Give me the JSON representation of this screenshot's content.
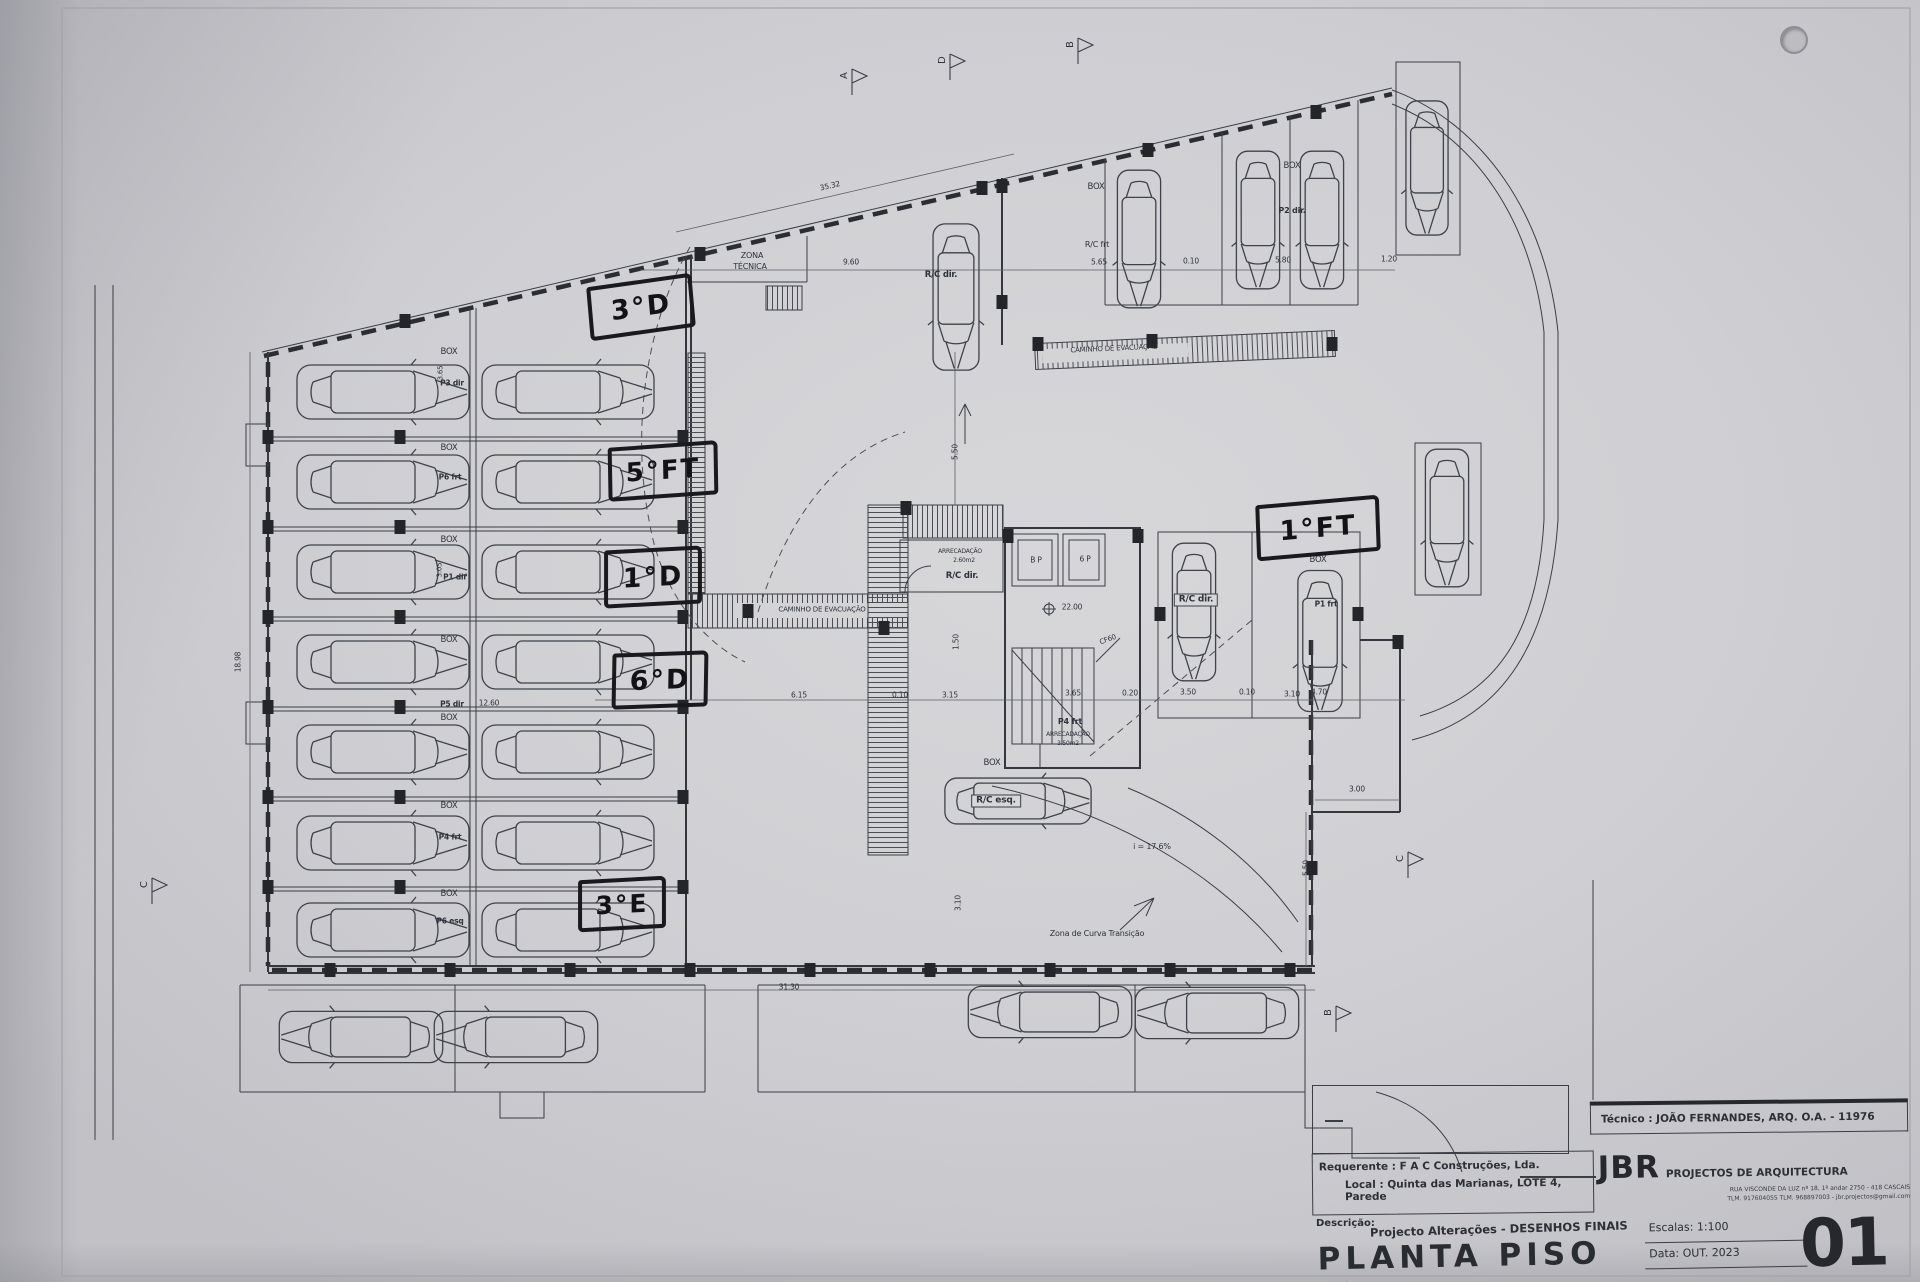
{
  "title_block": {
    "tecnico": "Técnico : JOÃO FERNANDES, ARQ.   O.A. - 11976",
    "firm_initials": "JBR",
    "firm_name": "PROJECTOS DE ARQUITECTURA",
    "firm_address": "RUA VISCONDE DA LUZ nº 18, 1º andar  2750 - 418  CASCAIS",
    "firm_contacts": "TLM. 917604055  TLM. 968897003 - jbr.projectos@gmail.com",
    "requerente": "Requerente : F A C  Construções, Lda.",
    "local": "Local : Quinta das Marianas, LOTE 4, Parede",
    "descricao_label": "Descrição:",
    "descricao": "Projecto Alterações - DESENHOS FINAIS",
    "title": "PLANTA PISO -2",
    "escala": "Escalas:  1:100",
    "data": "Data:  OUT.  2023",
    "sheet_number": "01"
  },
  "handwritten": [
    {
      "t": "3°D",
      "x": 588,
      "y": 280,
      "w": 98,
      "h": 46,
      "r": -8,
      "fs": 27
    },
    {
      "t": "5°FT",
      "x": 608,
      "y": 444,
      "w": 102,
      "h": 46,
      "r": -4,
      "fs": 26
    },
    {
      "t": "1°D",
      "x": 604,
      "y": 548,
      "w": 90,
      "h": 50,
      "r": -3,
      "fs": 27
    },
    {
      "t": "6°D",
      "x": 612,
      "y": 652,
      "w": 88,
      "h": 48,
      "r": -2,
      "fs": 27
    },
    {
      "t": "3°E",
      "x": 578,
      "y": 878,
      "w": 80,
      "h": 44,
      "r": -3,
      "fs": 25
    },
    {
      "t": "1°FT",
      "x": 1256,
      "y": 500,
      "w": 116,
      "h": 48,
      "r": -5,
      "fs": 27
    }
  ],
  "labels": [
    {
      "t": "ZONA",
      "x": 752,
      "y": 256,
      "s": 8
    },
    {
      "t": "TÉCNICA",
      "x": 750,
      "y": 267,
      "s": 8
    },
    {
      "t": "CAMINHO  DE  EVACUAÇÃO",
      "x": 822,
      "y": 610,
      "s": 7
    },
    {
      "t": "CAMINHO  DE  EVACUAÇÃO",
      "x": 1114,
      "y": 349,
      "s": 7,
      "r": -2.5
    },
    {
      "t": "BOX",
      "x": 449,
      "y": 352,
      "s": 8.5
    },
    {
      "t": "BOX",
      "x": 449,
      "y": 448,
      "s": 8.5
    },
    {
      "t": "BOX",
      "x": 449,
      "y": 540,
      "s": 8.5
    },
    {
      "t": "BOX",
      "x": 449,
      "y": 640,
      "s": 8.5
    },
    {
      "t": "BOX",
      "x": 449,
      "y": 718,
      "s": 8.5
    },
    {
      "t": "BOX",
      "x": 449,
      "y": 806,
      "s": 8.5
    },
    {
      "t": "BOX",
      "x": 449,
      "y": 894,
      "s": 8.5
    },
    {
      "t": "P3 dir",
      "x": 452,
      "y": 383,
      "s": 7.5,
      "b": 1
    },
    {
      "t": "P6 frt",
      "x": 450,
      "y": 477,
      "s": 7.5,
      "b": 1
    },
    {
      "t": "P1 dir",
      "x": 455,
      "y": 577,
      "s": 7.5,
      "b": 1
    },
    {
      "t": "P5 dir",
      "x": 452,
      "y": 704,
      "s": 7.5,
      "b": 1
    },
    {
      "t": "P4 frt",
      "x": 450,
      "y": 837,
      "s": 7.5,
      "b": 1
    },
    {
      "t": "P6 esq",
      "x": 450,
      "y": 921,
      "s": 7.5,
      "b": 1
    },
    {
      "t": "3.65",
      "x": 441,
      "y": 373,
      "s": 7,
      "r": -90
    },
    {
      "t": "3.05",
      "x": 440,
      "y": 570,
      "s": 7,
      "r": -90
    },
    {
      "t": "12.60",
      "x": 489,
      "y": 703,
      "s": 7.5
    },
    {
      "t": "18.98",
      "x": 238,
      "y": 662,
      "s": 7.5,
      "r": -90
    },
    {
      "t": "35.32",
      "x": 830,
      "y": 186,
      "s": 7.5,
      "r": -13
    },
    {
      "t": "9.60",
      "x": 851,
      "y": 262,
      "s": 7.5
    },
    {
      "t": "5.65",
      "x": 1099,
      "y": 262,
      "s": 7.5
    },
    {
      "t": "0.10",
      "x": 1191,
      "y": 261,
      "s": 7.5
    },
    {
      "t": "5.80",
      "x": 1283,
      "y": 260,
      "s": 7.5
    },
    {
      "t": "1.20",
      "x": 1389,
      "y": 259,
      "s": 7.5
    },
    {
      "t": "6.15",
      "x": 799,
      "y": 695,
      "s": 7.5
    },
    {
      "t": "0.10",
      "x": 900,
      "y": 695,
      "s": 7.5
    },
    {
      "t": "3.15",
      "x": 950,
      "y": 695,
      "s": 7.5
    },
    {
      "t": "3.65",
      "x": 1073,
      "y": 693,
      "s": 7.5
    },
    {
      "t": "0.20",
      "x": 1130,
      "y": 693,
      "s": 7.5
    },
    {
      "t": "3.50",
      "x": 1188,
      "y": 692,
      "s": 7.5
    },
    {
      "t": "0.10",
      "x": 1247,
      "y": 692,
      "s": 7.5
    },
    {
      "t": "3.10",
      "x": 1292,
      "y": 694,
      "s": 7.5
    },
    {
      "t": "4.70",
      "x": 1319,
      "y": 692,
      "s": 7.5
    },
    {
      "t": "3.00",
      "x": 1357,
      "y": 789,
      "s": 7.5
    },
    {
      "t": "5.50",
      "x": 1306,
      "y": 868,
      "s": 7.5,
      "r": -90
    },
    {
      "t": "5.50",
      "x": 955,
      "y": 452,
      "s": 7.5,
      "r": -90
    },
    {
      "t": "1.50",
      "x": 956,
      "y": 642,
      "s": 7.5,
      "r": -90
    },
    {
      "t": "3.10",
      "x": 958,
      "y": 903,
      "s": 7.5,
      "r": -90
    },
    {
      "t": "31.30",
      "x": 789,
      "y": 987,
      "s": 7.5
    },
    {
      "t": "BOX",
      "x": 1096,
      "y": 187,
      "s": 8.5
    },
    {
      "t": "R/C frt",
      "x": 1097,
      "y": 245,
      "s": 8
    },
    {
      "t": "BOX",
      "x": 1292,
      "y": 166,
      "s": 8.5
    },
    {
      "t": "P2 dir.",
      "x": 1292,
      "y": 211,
      "s": 8,
      "b": 1
    },
    {
      "t": "R/C dir.",
      "x": 941,
      "y": 275,
      "s": 8.5,
      "b": 1
    },
    {
      "t": "BOX",
      "x": 1318,
      "y": 560,
      "s": 8.5
    },
    {
      "t": "P1 frt",
      "x": 1326,
      "y": 604,
      "s": 7.5,
      "b": 1
    },
    {
      "t": "BOX",
      "x": 992,
      "y": 763,
      "s": 8.5
    },
    {
      "t": "R/C esq.",
      "x": 996,
      "y": 801,
      "s": 9,
      "b": 1,
      "c": 1
    },
    {
      "t": "R/C dir.",
      "x": 1196,
      "y": 600,
      "s": 9,
      "b": 1,
      "c": 1
    },
    {
      "t": "B P",
      "x": 1036,
      "y": 560,
      "s": 7.5
    },
    {
      "t": "6 P",
      "x": 1085,
      "y": 559,
      "s": 7.5
    },
    {
      "t": "22.00",
      "x": 1072,
      "y": 607,
      "s": 7.5
    },
    {
      "t": "CF60",
      "x": 1108,
      "y": 640,
      "s": 7,
      "r": -20
    },
    {
      "t": "ARRECADAÇÃO",
      "x": 960,
      "y": 552,
      "s": 6
    },
    {
      "t": "2.60m2",
      "x": 964,
      "y": 561,
      "s": 6
    },
    {
      "t": "R/C dir.",
      "x": 962,
      "y": 576,
      "s": 8.5,
      "b": 1
    },
    {
      "t": "P4 frt",
      "x": 1070,
      "y": 722,
      "s": 8,
      "b": 1
    },
    {
      "t": "ARRECADAÇÃO",
      "x": 1068,
      "y": 735,
      "s": 6
    },
    {
      "t": "3.50m2",
      "x": 1068,
      "y": 744,
      "s": 6
    },
    {
      "t": "i = 17.6%",
      "x": 1152,
      "y": 847,
      "s": 8
    },
    {
      "t": "Zona de Curva Transição",
      "x": 1097,
      "y": 934,
      "s": 8
    }
  ],
  "cars": [
    [
      383,
      392,
      0,
      1
    ],
    [
      568,
      392,
      0,
      1
    ],
    [
      383,
      482,
      0,
      1
    ],
    [
      568,
      482,
      0,
      1
    ],
    [
      383,
      572,
      0,
      1
    ],
    [
      568,
      572,
      0,
      1
    ],
    [
      383,
      662,
      0,
      1
    ],
    [
      568,
      662,
      0,
      1
    ],
    [
      383,
      752,
      0,
      1
    ],
    [
      568,
      752,
      0,
      1
    ],
    [
      383,
      843,
      0,
      1
    ],
    [
      568,
      843,
      0,
      1
    ],
    [
      383,
      930,
      0,
      1
    ],
    [
      568,
      930,
      0,
      1
    ],
    [
      361,
      1037,
      180,
      0.95
    ],
    [
      516,
      1037,
      180,
      0.95
    ],
    [
      1050,
      1012,
      180,
      0.95
    ],
    [
      1217,
      1013,
      180,
      0.95
    ],
    [
      956,
      297,
      90,
      0.85
    ],
    [
      1139,
      239,
      90,
      0.8
    ],
    [
      1258,
      220,
      90,
      0.8
    ],
    [
      1322,
      220,
      90,
      0.8
    ],
    [
      1427,
      168,
      90,
      0.78
    ],
    [
      1194,
      612,
      90,
      0.8
    ],
    [
      1320,
      641,
      90,
      0.82
    ],
    [
      1447,
      518,
      90,
      0.8
    ],
    [
      1018,
      801,
      0,
      0.85
    ]
  ],
  "columns": [
    [
      405,
      321
    ],
    [
      700,
      254
    ],
    [
      982,
      188
    ],
    [
      1148,
      150
    ],
    [
      1316,
      112
    ],
    [
      268,
      437
    ],
    [
      268,
      527
    ],
    [
      268,
      617
    ],
    [
      268,
      707
    ],
    [
      268,
      797
    ],
    [
      268,
      887
    ],
    [
      400,
      437
    ],
    [
      400,
      527
    ],
    [
      400,
      617
    ],
    [
      400,
      707
    ],
    [
      400,
      797
    ],
    [
      400,
      887
    ],
    [
      683,
      437
    ],
    [
      683,
      527
    ],
    [
      683,
      617
    ],
    [
      683,
      707
    ],
    [
      683,
      797
    ],
    [
      683,
      887
    ],
    [
      330,
      970
    ],
    [
      450,
      970
    ],
    [
      570,
      970
    ],
    [
      690,
      970
    ],
    [
      810,
      970
    ],
    [
      930,
      970
    ],
    [
      1050,
      970
    ],
    [
      1170,
      970
    ],
    [
      1290,
      970
    ],
    [
      748,
      611
    ],
    [
      884,
      628
    ],
    [
      906,
      508
    ],
    [
      1008,
      536
    ],
    [
      1138,
      536
    ],
    [
      1160,
      614
    ],
    [
      1358,
      614
    ],
    [
      1312,
      868
    ],
    [
      1398,
      642
    ],
    [
      1002,
      186
    ],
    [
      1002,
      302
    ],
    [
      1038,
      344
    ],
    [
      1152,
      341
    ],
    [
      1332,
      344
    ]
  ],
  "section_markers": [
    {
      "t": "A",
      "x": 852,
      "y": 75
    },
    {
      "t": "D",
      "x": 950,
      "y": 60
    },
    {
      "t": "B",
      "x": 1078,
      "y": 44
    },
    {
      "t": "C",
      "x": 152,
      "y": 884
    },
    {
      "t": "C",
      "x": 1408,
      "y": 858
    },
    {
      "t": "B",
      "x": 1336,
      "y": 1012
    }
  ]
}
